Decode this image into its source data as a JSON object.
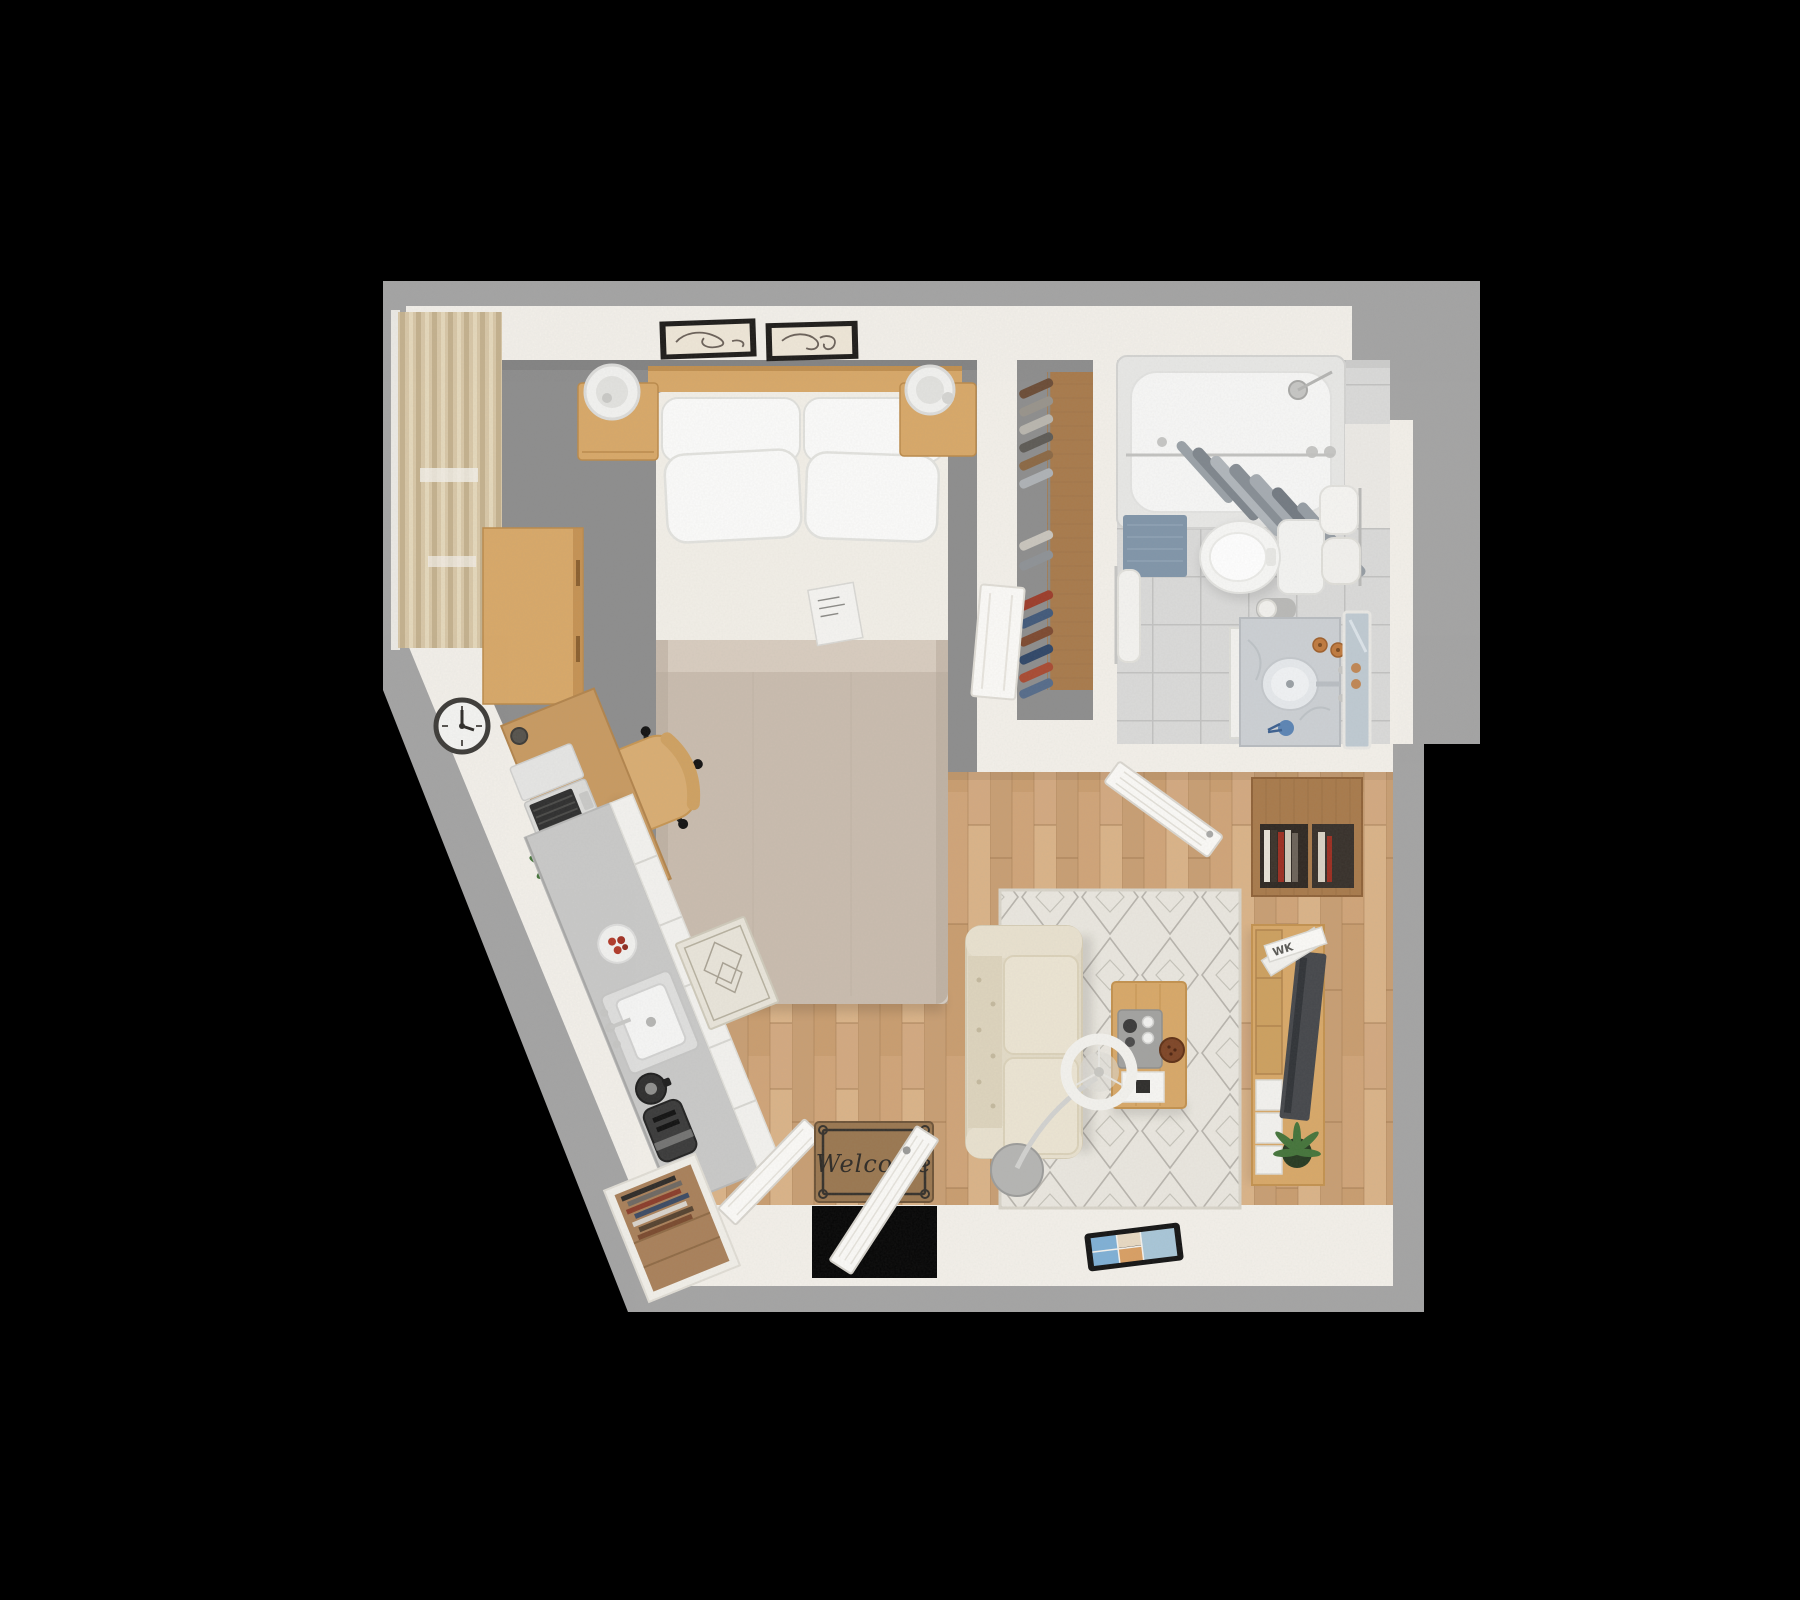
{
  "scene": {
    "description": "Top-down 3D rendered floor plan of a studio apartment on a black background",
    "background": "#000000"
  },
  "texts": {
    "welcome_mat": "Welcome",
    "magazine_spine": "WK"
  },
  "palette": {
    "background": "#000000",
    "slab": "#a4a4a4",
    "wall": "#f3f0ea",
    "carpet": "#8d8d8d",
    "wood_floor": "#d0a478",
    "tile": "#dadad9",
    "counter": "#c9c9c8",
    "cabinet_white": "#f3f2ef",
    "door": "#fbfaf7",
    "oak": "#d8a868",
    "oak_dark": "#c08c4e",
    "walnut": "#a87a4b",
    "rug": "#eae7df",
    "rug_line": "#8e8b82",
    "sofa": "#e3dbc7",
    "sofa_cushion": "#ece5d3",
    "sheet": "#f2efe8",
    "duvet": "#c9bcae",
    "pillow": "#fbfbfa",
    "curtain": "#d8c7a7",
    "bath_mat": "#8095a9",
    "welcome_mat": "#9a7750",
    "mat_text": "#2e2a25",
    "tv": "#45474b",
    "plant": "#44743a",
    "plant_dark": "#263a21",
    "chrome": "#c6c6c4",
    "lamp_shade": "#f3f2ee"
  },
  "closet": {
    "hanger_colors": [
      "#6b4c36",
      "#98938b",
      "#b9b6ae",
      "#5d5a55",
      "#8b6844",
      "#aeb2b6",
      "#c9c5bd",
      "#8e9296",
      "#9c3c2a",
      "#41597a",
      "#7d4930",
      "#2f4668",
      "#a84a32",
      "#556b8a"
    ]
  },
  "entry": {
    "shoe_stripe_colors": [
      "#2e2b28",
      "#6e6862",
      "#8a3c2a",
      "#3c4a63",
      "#d9d4cc",
      "#55422f",
      "#7a4a2e"
    ]
  },
  "living_room": {
    "book_colors": [
      "#e9e3d7",
      "#3b332b",
      "#9c2d20",
      "#cfc8b9",
      "#6b6258",
      "#d9d2c4"
    ]
  },
  "rooms": [
    {
      "id": "bedroom",
      "items": [
        "bed",
        "pillows",
        "duvet",
        "headboard",
        "nightstand-left",
        "nightstand-right",
        "table-lamp-left",
        "table-lamp-right",
        "wall-art-1",
        "wall-art-2",
        "dresser",
        "window-curtains",
        "wall-clock",
        "book-on-bed",
        "desk",
        "laptop",
        "desk-plant",
        "office-chair"
      ]
    },
    {
      "id": "closet-corridor",
      "items": [
        "wardrobe-panel",
        "clothes-rail",
        "hanging-clothes",
        "leaning-door-panel"
      ]
    },
    {
      "id": "bathroom",
      "items": [
        "bathtub",
        "shower-head",
        "shower-curtain",
        "curtain-rod",
        "bath-mat",
        "toilet",
        "toilet-paper-holder",
        "towel-stack",
        "hand-towel",
        "vanity",
        "vanity-sink",
        "vanity-faucet",
        "soap-bottles",
        "toothbrush-cup",
        "leaning-mirror"
      ]
    },
    {
      "id": "living-room",
      "items": [
        "area-rug",
        "sofa",
        "coffee-table",
        "serving-tray",
        "espresso-pot",
        "snack-bowl",
        "arc-floor-lamp",
        "tv-console",
        "tv",
        "magazines",
        "potted-plant",
        "wall-shelf",
        "books",
        "tablet-on-floor",
        "open-bathroom-door"
      ]
    },
    {
      "id": "kitchen",
      "items": [
        "counter",
        "cabinet-fronts",
        "kitchen-sink",
        "kitchen-faucet",
        "plate",
        "coffee-maker",
        "toaster",
        "runner-rug"
      ]
    },
    {
      "id": "entry",
      "items": [
        "front-door-opening",
        "front-door",
        "welcome-mat",
        "shoe-closet",
        "closet-door"
      ]
    }
  ]
}
